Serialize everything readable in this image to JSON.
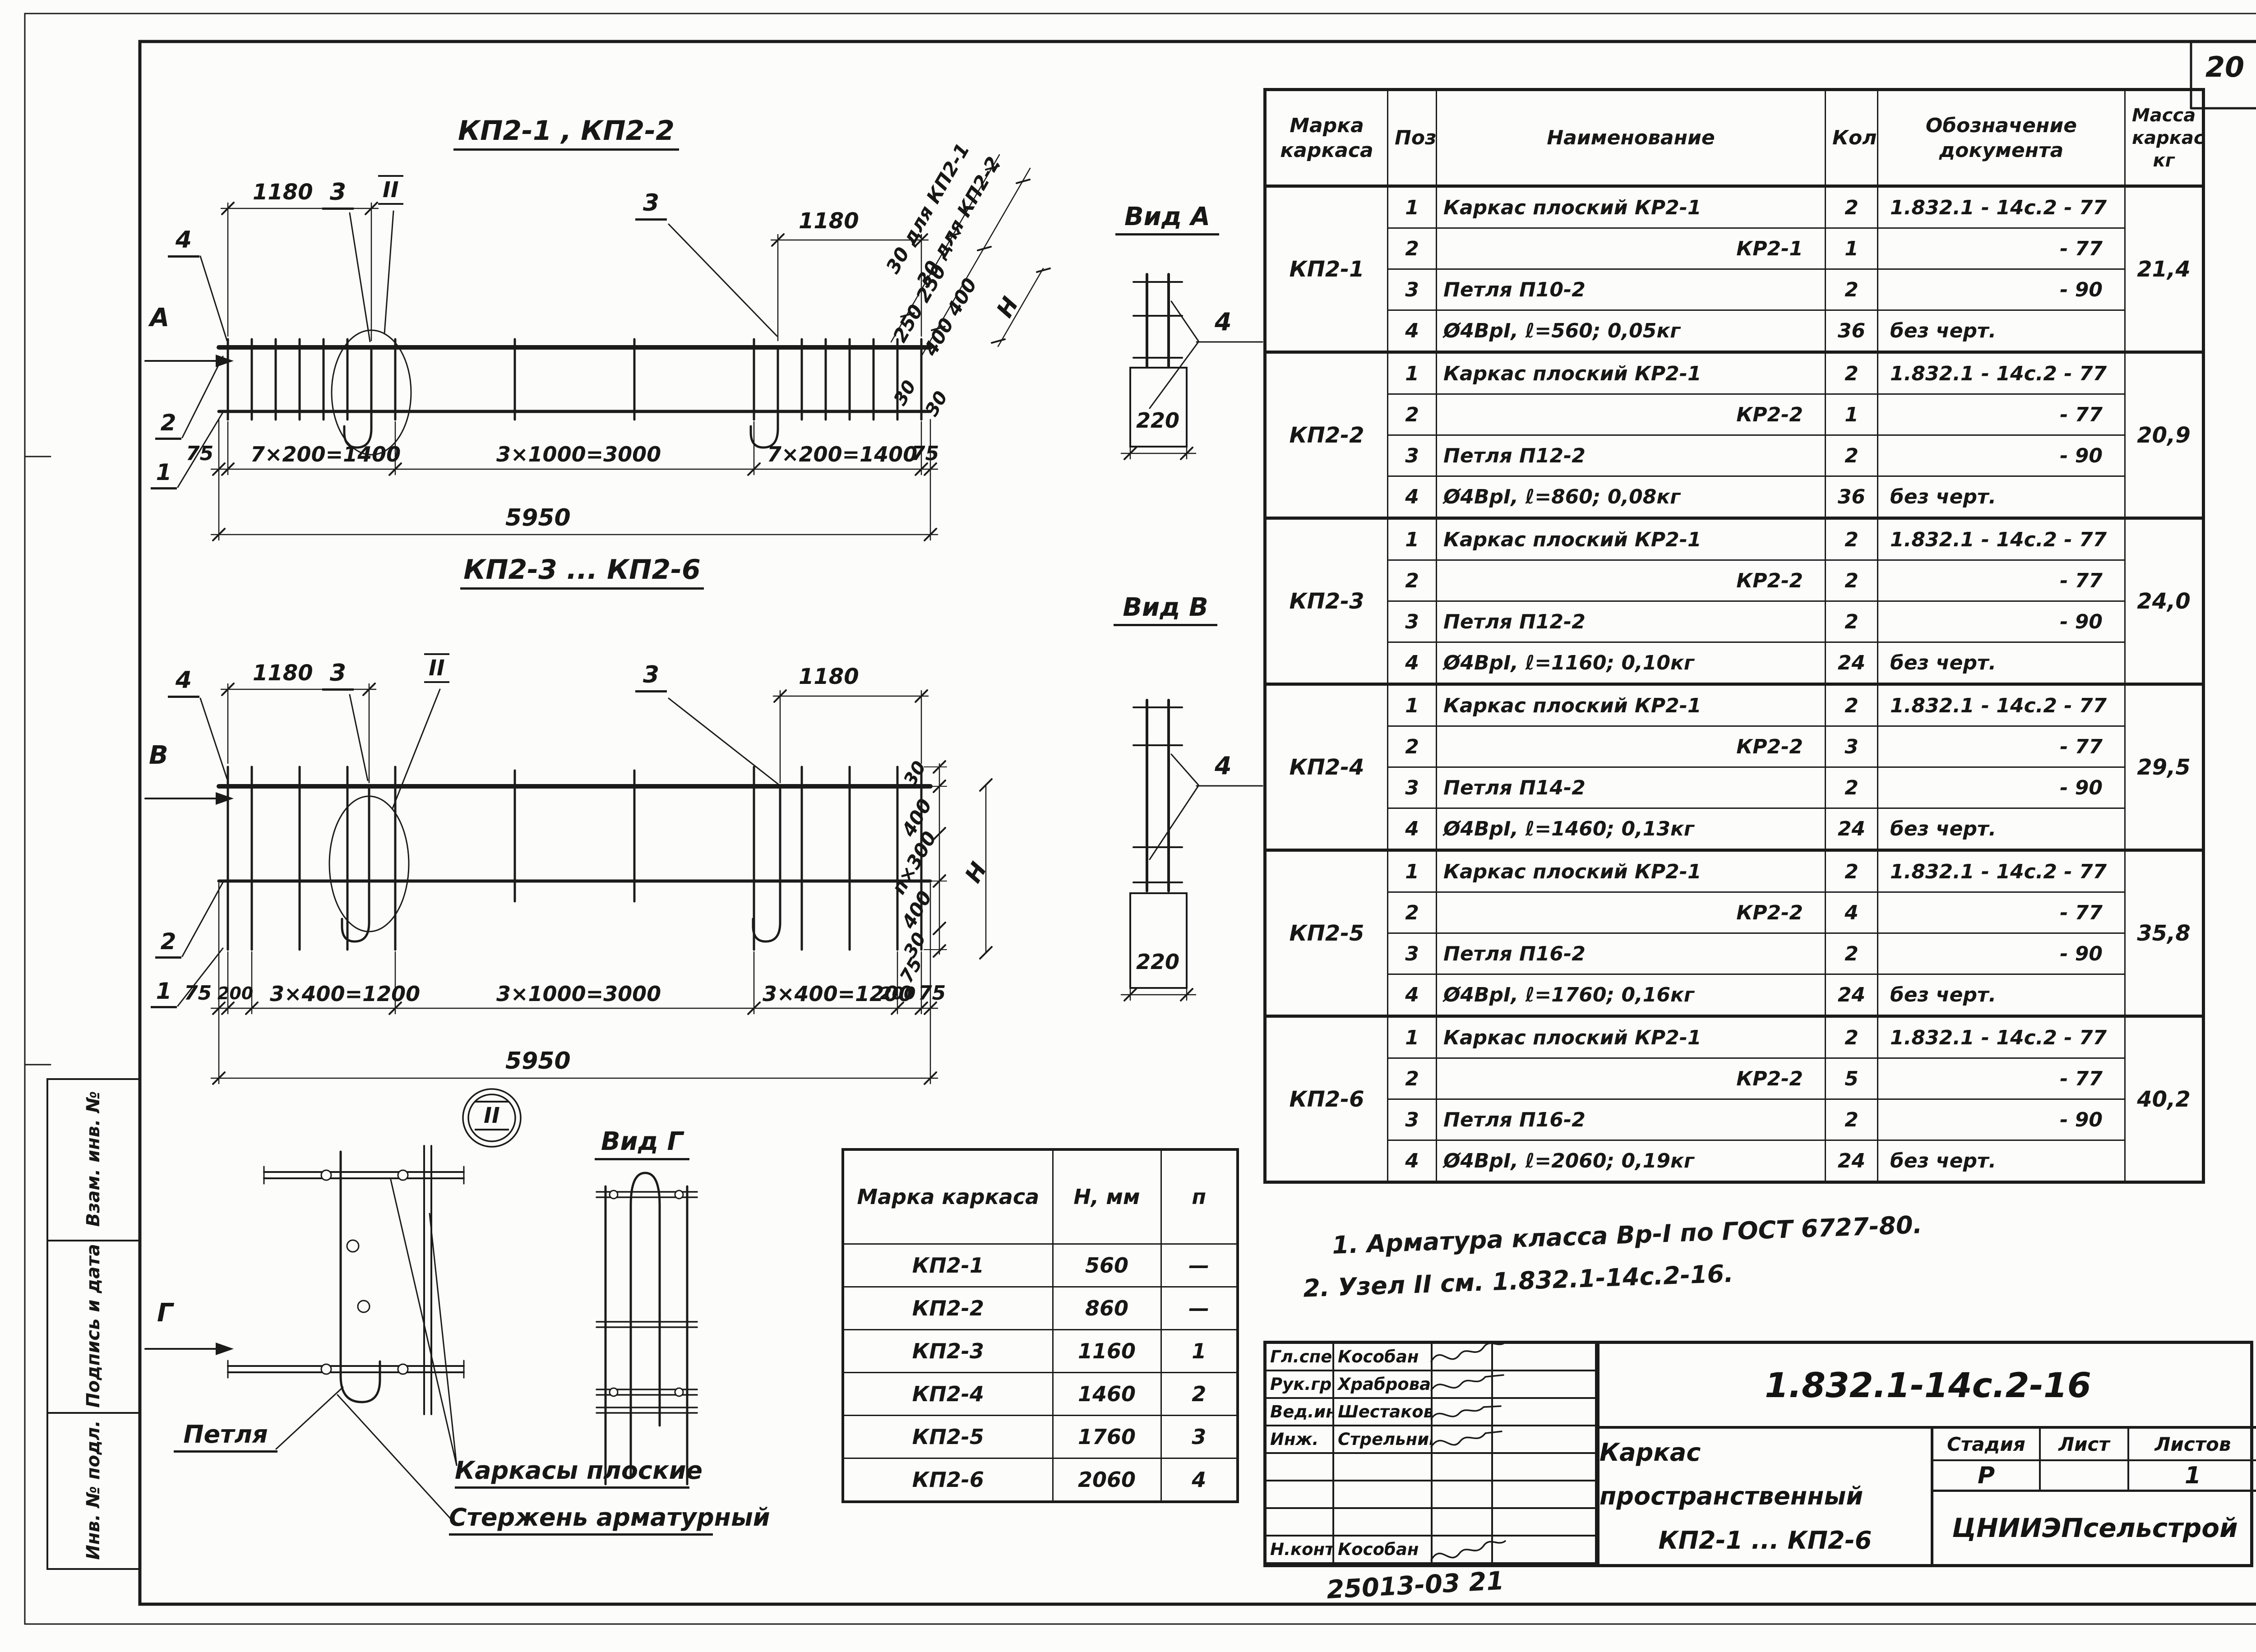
{
  "page": {
    "sheet_corner_number": "20",
    "doc_stamp_note": "25013-03  21"
  },
  "margin": {
    "vzam": "Взам. инв. №",
    "podpis": "Подпись и дата",
    "inv": "Инв. № подл."
  },
  "drawing1": {
    "title": "КП2-1 , КП2-2",
    "dim_1180_left": "1180",
    "dim_1180_right": "1180",
    "label_3_left": "3",
    "label_node": "II",
    "label_3_right": "3",
    "label_4": "4",
    "label_1": "1",
    "label_2": "2",
    "view_arrow": "А",
    "dim_75_left": "75",
    "dim_seg_left": "7×200=1400",
    "dim_seg_mid": "3×1000=3000",
    "dim_seg_right": "7×200=1400",
    "dim_75_right": "75",
    "dim_total": "5950",
    "right_line1": "30 для КП2-1",
    "right_line2": "30 для КП2-2",
    "right_250": "250  250",
    "right_400": "400  400",
    "right_H": "Н",
    "right_30a": "30",
    "right_30b": "30"
  },
  "view_a": {
    "title": "Вид А",
    "width": "220",
    "label_4": "4"
  },
  "drawing2": {
    "title": "КП2-3 ... КП2-6",
    "dim_1180_left": "1180",
    "dim_1180_right": "1180",
    "label_3_left": "3",
    "label_node": "II",
    "label_3_right": "3",
    "label_4": "4",
    "label_1": "1",
    "label_2": "2",
    "view_arrow": "В",
    "dim_75_left": "75",
    "dim_200_left": "200",
    "dim_seg_left": "3×400=1200",
    "dim_seg_mid": "3×1000=3000",
    "dim_seg_right": "3×400=1200",
    "dim_200_right": "200",
    "dim_75_right": "75",
    "dim_total": "5950",
    "right_30t": "30",
    "right_400t": "400",
    "right_mid": "п×300",
    "right_400b": "400",
    "right_30b": "30",
    "right_H": "Н",
    "right_75": "75"
  },
  "view_b": {
    "title": "Вид В",
    "width": "220",
    "label_4": "4"
  },
  "node_detail": {
    "bubble": "II",
    "view_title": "Вид Г",
    "view_arrow": "Г",
    "label_loop": "Петля",
    "label_cages": "Каркасы плоские",
    "label_rod": "Стержень арматурный"
  },
  "size_table": {
    "headers": [
      "Марка каркаса",
      "Н, мм",
      "п"
    ],
    "rows": [
      [
        "КП2-1",
        "560",
        "—"
      ],
      [
        "КП2-2",
        "860",
        "—"
      ],
      [
        "КП2-3",
        "1160",
        "1"
      ],
      [
        "КП2-4",
        "1460",
        "2"
      ],
      [
        "КП2-5",
        "1760",
        "3"
      ],
      [
        "КП2-6",
        "2060",
        "4"
      ]
    ]
  },
  "bom": {
    "headers": {
      "mark": "Марка каркаса",
      "pos": "Поз.",
      "name": "Наименование",
      "qty": "Кол.",
      "doc": "Обозначение документа",
      "mass": "Масса каркаса, кг"
    },
    "groups": [
      {
        "mark": "КП2-1",
        "mass": "21,4",
        "rows": [
          [
            "1",
            "Каркас плоский КР2-1",
            "2",
            "1.832.1 - 14с.2 - 77"
          ],
          [
            "2",
            "КР2-1",
            "1",
            "- 77"
          ],
          [
            "3",
            "Петля П10-2",
            "2",
            "- 90"
          ],
          [
            "4",
            "Ø4ВрI, ℓ=560; 0,05кг",
            "36",
            "без черт."
          ]
        ]
      },
      {
        "mark": "КП2-2",
        "mass": "20,9",
        "rows": [
          [
            "1",
            "Каркас плоский КР2-1",
            "2",
            "1.832.1 - 14с.2 - 77"
          ],
          [
            "2",
            "КР2-2",
            "1",
            "- 77"
          ],
          [
            "3",
            "Петля П12-2",
            "2",
            "- 90"
          ],
          [
            "4",
            "Ø4ВрI, ℓ=860; 0,08кг",
            "36",
            "без черт."
          ]
        ]
      },
      {
        "mark": "КП2-3",
        "mass": "24,0",
        "rows": [
          [
            "1",
            "Каркас плоский КР2-1",
            "2",
            "1.832.1 - 14с.2 - 77"
          ],
          [
            "2",
            "КР2-2",
            "2",
            "- 77"
          ],
          [
            "3",
            "Петля П12-2",
            "2",
            "- 90"
          ],
          [
            "4",
            "Ø4ВрI, ℓ=1160; 0,10кг",
            "24",
            "без черт."
          ]
        ]
      },
      {
        "mark": "КП2-4",
        "mass": "29,5",
        "rows": [
          [
            "1",
            "Каркас плоский КР2-1",
            "2",
            "1.832.1 - 14с.2 - 77"
          ],
          [
            "2",
            "КР2-2",
            "3",
            "- 77"
          ],
          [
            "3",
            "Петля П14-2",
            "2",
            "- 90"
          ],
          [
            "4",
            "Ø4ВрI, ℓ=1460; 0,13кг",
            "24",
            "без черт."
          ]
        ]
      },
      {
        "mark": "КП2-5",
        "mass": "35,8",
        "rows": [
          [
            "1",
            "Каркас плоский КР2-1",
            "2",
            "1.832.1 - 14с.2 - 77"
          ],
          [
            "2",
            "КР2-2",
            "4",
            "- 77"
          ],
          [
            "3",
            "Петля П16-2",
            "2",
            "- 90"
          ],
          [
            "4",
            "Ø4ВрI, ℓ=1760; 0,16кг",
            "24",
            "без черт."
          ]
        ]
      },
      {
        "mark": "КП2-6",
        "mass": "40,2",
        "rows": [
          [
            "1",
            "Каркас плоский КР2-1",
            "2",
            "1.832.1 - 14с.2 - 77"
          ],
          [
            "2",
            "КР2-2",
            "5",
            "- 77"
          ],
          [
            "3",
            "Петля П16-2",
            "2",
            "- 90"
          ],
          [
            "4",
            "Ø4ВрI, ℓ=2060; 0,19кг",
            "24",
            "без черт."
          ]
        ]
      }
    ]
  },
  "notes": {
    "n1": "1. Арматура  класса Вр-I  по ГОСТ 6727-80.",
    "n2": "2. Узел II см.  1.832.1-14с.2-16."
  },
  "titleblock": {
    "doc_number": "1.832.1-14с.2-16",
    "title_line1": "Каркас пространственный",
    "title_line2": "КП2-1 ... КП2-6",
    "org": "ЦНИИЭПсельстрой",
    "stage_label": "Стадия",
    "sheet_label": "Лист",
    "sheets_label": "Листов",
    "stage": "Р",
    "sheet": "",
    "sheets": "1",
    "staff": [
      {
        "role": "Гл.спец.",
        "name": "Кособан"
      },
      {
        "role": "Рук.гр.",
        "name": "Храброва"
      },
      {
        "role": "Вед.инж.",
        "name": "Шестакова"
      },
      {
        "role": "Инж.",
        "name": "Стрельникова"
      },
      {
        "role": "",
        "name": ""
      },
      {
        "role": "",
        "name": ""
      },
      {
        "role": "",
        "name": ""
      },
      {
        "role": "Н.контр.",
        "name": "Кособан"
      }
    ]
  }
}
